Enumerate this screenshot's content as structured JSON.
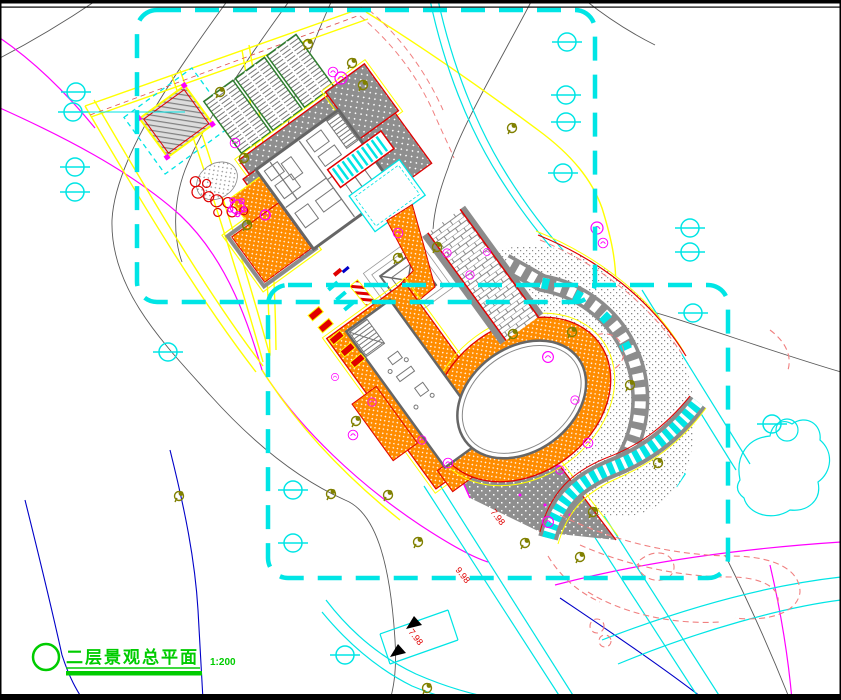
{
  "drawing": {
    "title_block": {
      "title": "二层景观总平面",
      "scale": "1:200"
    },
    "elevation_labels": [
      "7.98",
      "9.98",
      "7.98"
    ],
    "legend": {
      "boundary_color": "#00E5E5",
      "paving_color": "#FF8C00",
      "road_color": "#FFFF00",
      "roof_color": "#8F8F8F",
      "contour_color": "#FF00FF",
      "title_color": "#00CC00",
      "tree_color": "#808000",
      "water_color": "#00E5E5"
    }
  }
}
